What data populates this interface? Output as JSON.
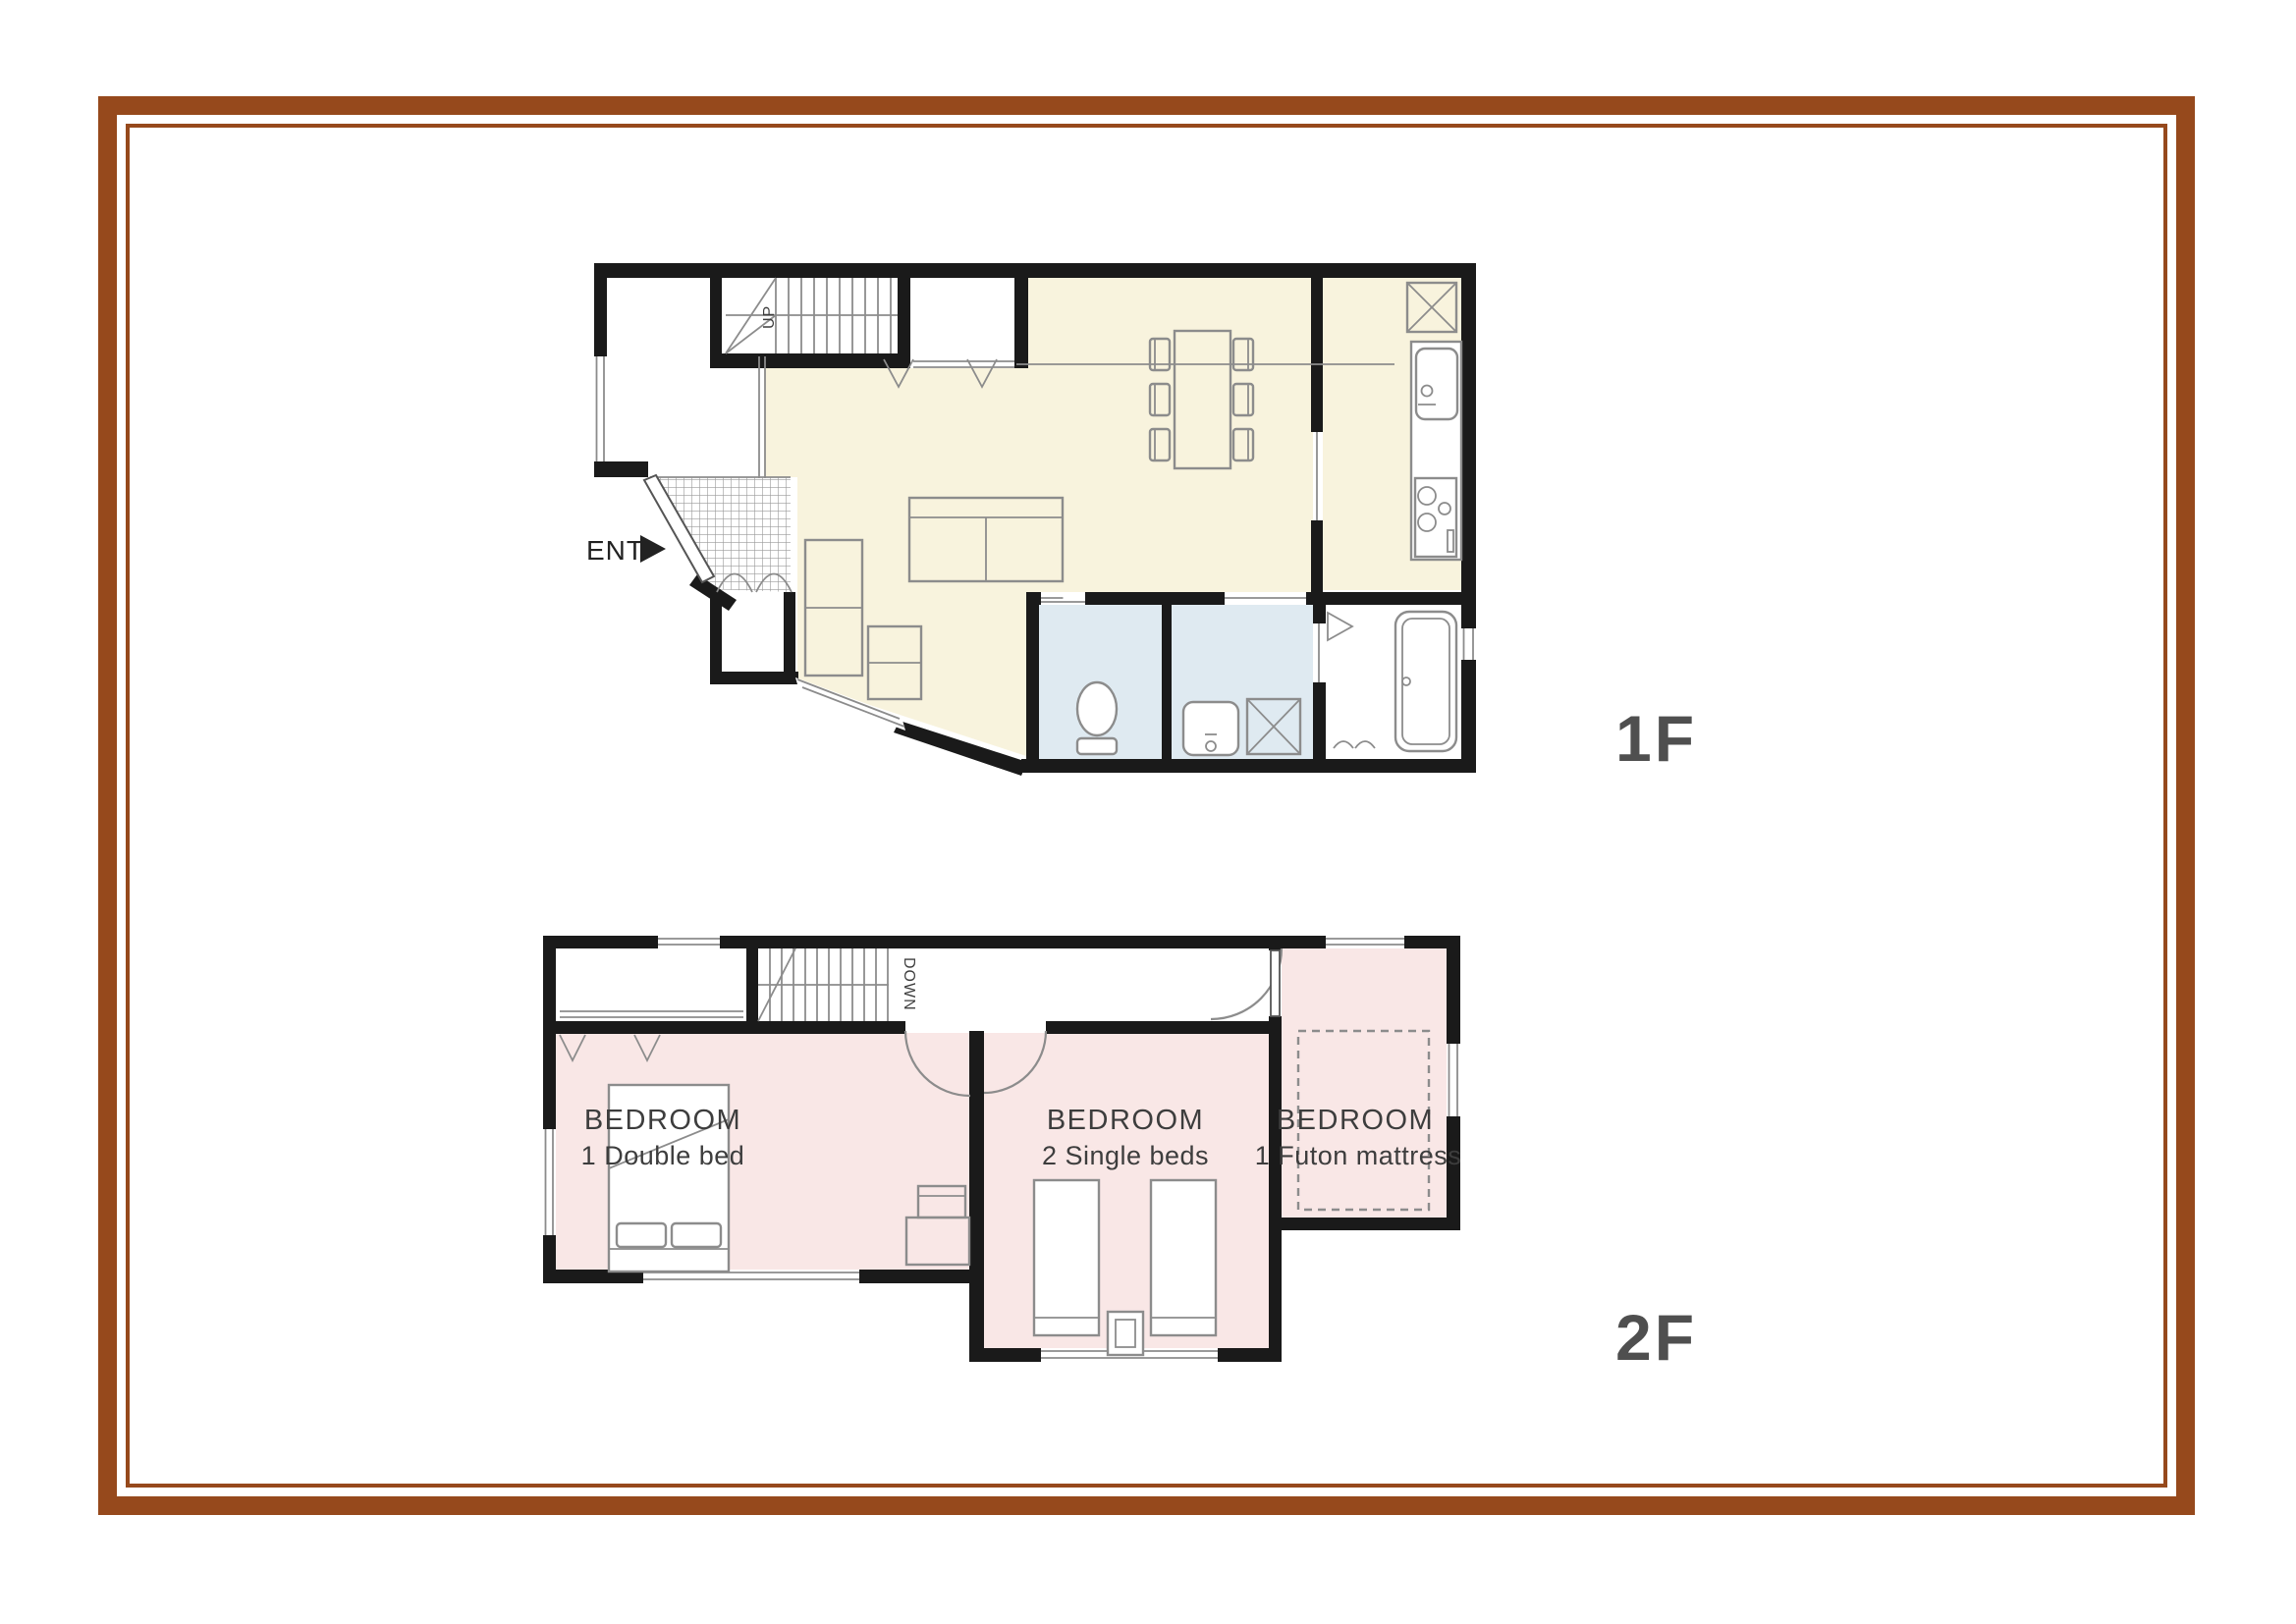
{
  "colors": {
    "frame": "#96491C",
    "wall": "#1a1a1a",
    "ldk": "#F8F3DD",
    "wet": "#DFEAF1",
    "bedroom": "#F9E7E6",
    "line": "#8c8c8c",
    "label": "#3d3d3d",
    "floor_label": "#4f4f4f"
  },
  "floor1": {
    "label": "1F",
    "entrance_label": "ENT",
    "stairs_label": "UP"
  },
  "floor2": {
    "label": "2F",
    "stairs_label": "DOWN",
    "bedrooms": [
      {
        "name": "BEDROOM",
        "beds": "1 Double bed"
      },
      {
        "name": "BEDROOM",
        "beds": "2 Single beds"
      },
      {
        "name": "BEDROOM",
        "beds": "1 Futon mattress"
      }
    ]
  }
}
